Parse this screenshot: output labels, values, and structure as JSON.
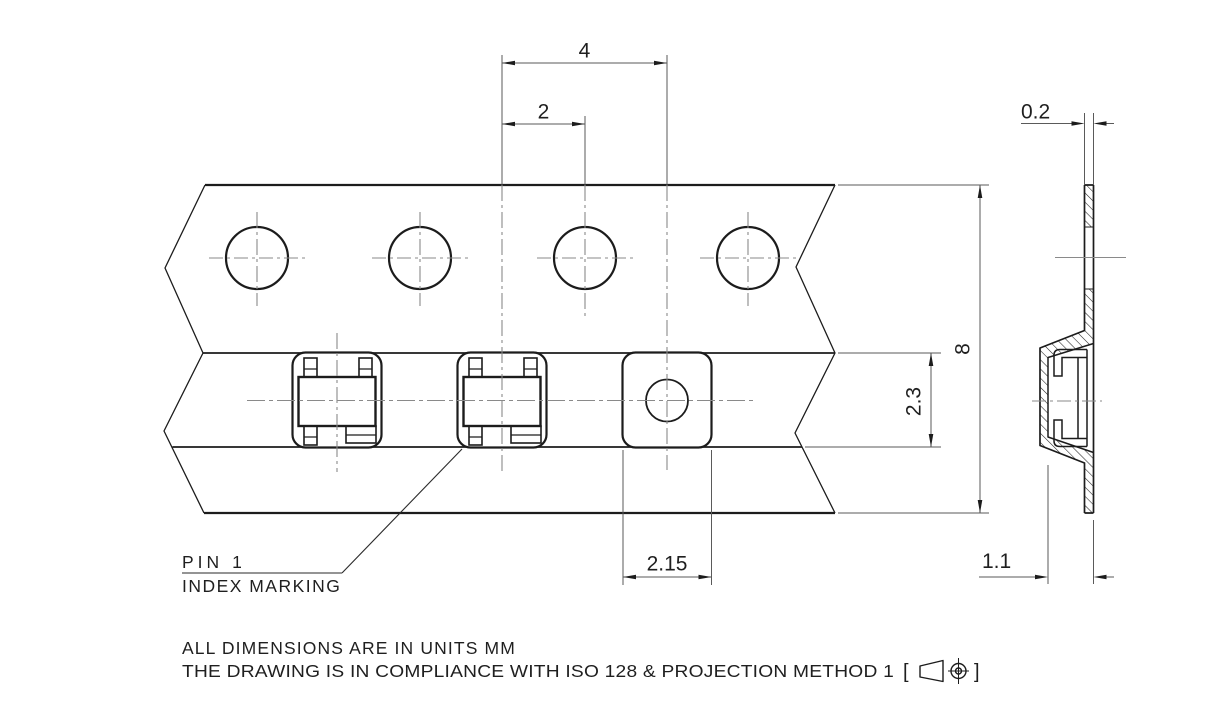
{
  "drawing": {
    "type": "carrier-tape-technical-drawing",
    "units": "mm",
    "views": [
      "top-view-tape-with-pockets",
      "side-section-view"
    ],
    "colors": {
      "background": "#ffffff",
      "object_line": "#1c1c1c",
      "dimension_line": "#5a5a5a",
      "centerline": "#8a8a8a",
      "text": "#1f1f1f"
    }
  },
  "dimensions": {
    "pocket_pitch": "4",
    "pocket_to_sprocket": "2",
    "tape_thickness": "0.2",
    "tape_width": "8",
    "pocket_length": "2.3",
    "pocket_width": "2.15",
    "pocket_depth": "1.1"
  },
  "annotations": {
    "pin1_line1": "PIN 1",
    "pin1_line2": "INDEX MARKING"
  },
  "notes": {
    "units_note": "ALL DIMENSIONS ARE IN UNITS MM",
    "compliance_note": "THE DRAWING IS IN COMPLIANCE WITH ISO 128 & PROJECTION METHOD 1",
    "bracket_open": "[",
    "bracket_close": "]",
    "projection_symbol": "first-angle-projection-symbol"
  }
}
